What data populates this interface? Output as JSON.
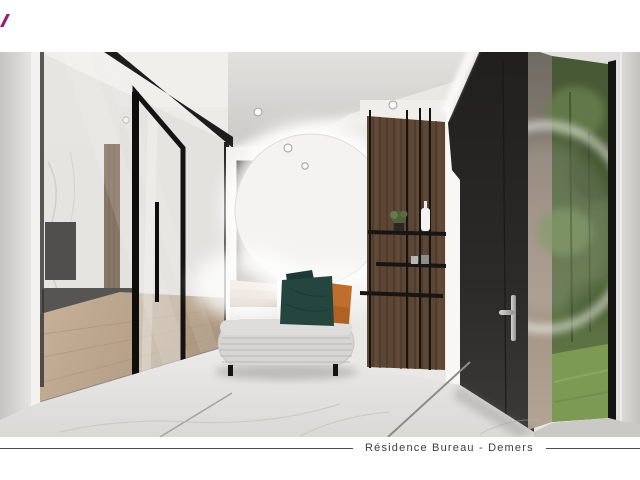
{
  "page": {
    "background": "#ffffff"
  },
  "logo": {
    "icon": "magenta-slash-logo-fragment",
    "color": "#9e1c6e"
  },
  "caption": {
    "title": "Résidence Bureau - Demers"
  },
  "scene": {
    "description": "Photorealistic 3D interior rendering of a residential entry hall",
    "objects": [
      "glass-partition-wall",
      "open-glass-door",
      "living-room-view",
      "tv-on-marble-wall",
      "wood-floor",
      "smoked-glass-door",
      "stair-steps",
      "round-backlit-mirror",
      "curved-upholstered-bench",
      "teal-cushions",
      "rust-cushion",
      "wood-slat-wall",
      "black-metal-shelving",
      "white-vase",
      "potted-plant",
      "black-entry-door",
      "silver-door-handle",
      "garden-window",
      "greenery",
      "marble-tile-floor",
      "ceiling-spotlights"
    ],
    "palette": {
      "ceiling": "#d5d3d0",
      "walls": "#eae8e5",
      "black_frames": "#1d1c1b",
      "wood": "#5d4633",
      "entry_door": "#2a2928",
      "greenery": "#54683f",
      "grass": "#7d9a55",
      "marble_floor": "#e9e7e4",
      "bench": "#d6d5d3",
      "teal_cushion": "#25463f",
      "rust_cushion": "#c06e2e",
      "handle_silver": "#c0c0bf"
    }
  }
}
